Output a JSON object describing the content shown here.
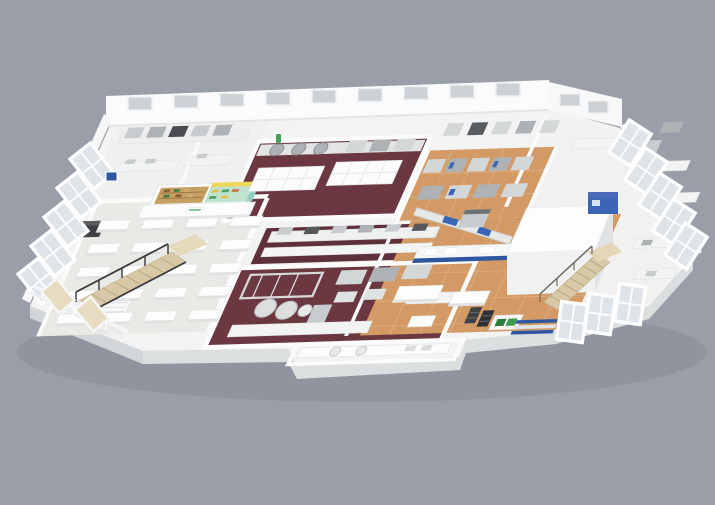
{
  "scene": {
    "type": "3d-isometric-cutaway-floorplan-render",
    "subject": "food production and laboratory facility",
    "background_color": "#9a9ea8"
  },
  "palette": {
    "slab_top": "#f2f3f2",
    "slab_side": "#dcdfe0",
    "slab_side_dark": "#d3d6d8",
    "wall_white": "#fafbfa",
    "window_glass": "#ccd1d6",
    "floor_light": "#e9eae5",
    "floor_maroon": "#6b3842",
    "floor_maroon_dark": "#5e3039",
    "floor_wood": "#d49a66",
    "cube_white": "#fcfdfc",
    "equipment_dark": "#3e4043",
    "accent_blue": "#2f57a0",
    "accent_blue_light": "#3a66b5",
    "accent_green": "#2f7d3a",
    "logo_green": "#4fae6d",
    "shelf_yellow": "#eed75c",
    "shelf_wood": "#c79f62",
    "shelf_teal": "#8fd0c0",
    "stair_tread": "#d8c8a7",
    "railing_dark": "#3a3a3c"
  },
  "zones": [
    {
      "id": "dining-test-hall",
      "floor_color": "#e9eae5"
    },
    {
      "id": "north-test-kitchen",
      "floor_color": "#6b3842"
    },
    {
      "id": "center-line-corridor",
      "floor_color": "#5e3039"
    },
    {
      "id": "south-main-kitchen",
      "floor_color": "#6b3842"
    },
    {
      "id": "production-hall-north",
      "floor_color": "#d49a66"
    },
    {
      "id": "production-hall-south",
      "floor_color": "#d49a66"
    },
    {
      "id": "cold-room",
      "floor_color": "#fcfdfc"
    }
  ]
}
